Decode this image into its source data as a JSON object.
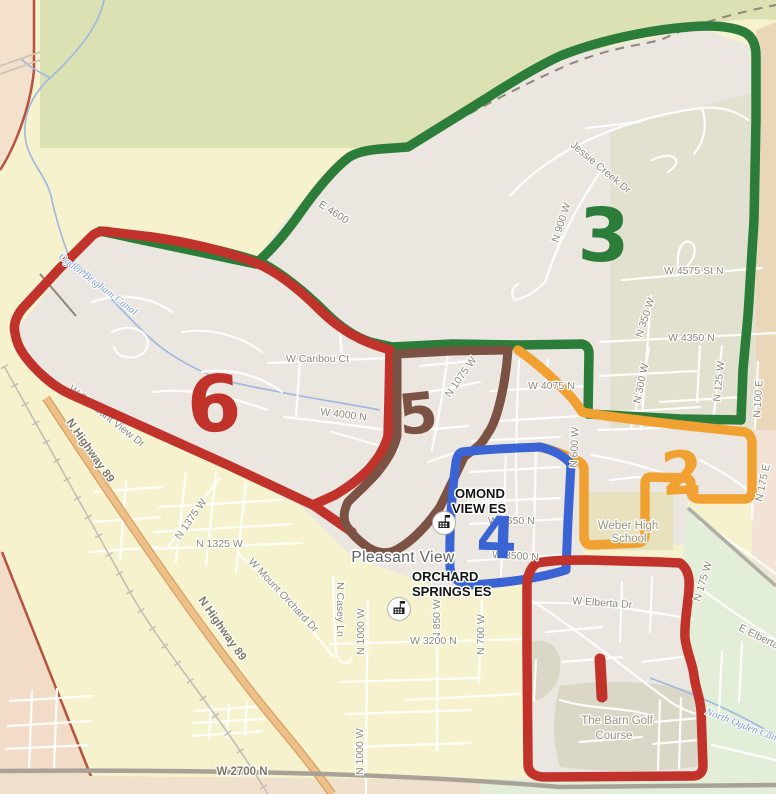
{
  "title": "Pleasant View elementary zones map",
  "city": {
    "name": "Pleasant View"
  },
  "zones": [
    {
      "id": "zone-1",
      "label": "1",
      "color": "#c1332a"
    },
    {
      "id": "zone-2",
      "label": "2",
      "color": "#f1a132"
    },
    {
      "id": "zone-3",
      "label": "3",
      "color": "#2c7d3a"
    },
    {
      "id": "zone-4",
      "label": "4",
      "color": "#3a63d3"
    },
    {
      "id": "zone-5",
      "label": "5",
      "color": "#7b5244"
    },
    {
      "id": "zone-6",
      "label": "6",
      "color": "#c1332a"
    }
  ],
  "places": {
    "ormond_view_line1": "OMOND",
    "ormond_view_line2": "VIEW ES",
    "orchard_springs_line1": "ORCHARD",
    "orchard_springs_line2": "SPRINGS ES",
    "weber_line1": "Weber High",
    "weber_line2": "School",
    "golf_line1": "The Barn Golf",
    "golf_line2": "Course"
  },
  "waterways": {
    "brigham_canal": "Ogden Brigham Canal",
    "north_ogden_canal": "North Ogden Canal"
  },
  "icons": {
    "school_icon": "school-building-with-flag"
  },
  "streets": {
    "jessie_creek": "Jessie Creek Dr",
    "n900w": "N 900 W",
    "w4575": "W 4575 St N",
    "n350w": "N 350 W",
    "w4350": "W 4350 N",
    "n300w": "N 300 W",
    "n125w": "N 125 W",
    "n100e": "N 100 E",
    "e4600": "E 4600",
    "w4075": "W 4075 N",
    "n600w": "N 600 W",
    "caribou": "W Caribou Ct",
    "n1075w": "N 1075 W",
    "w4000": "W 4000 N",
    "pleasant_view_dr": "W Pleasant View Dr",
    "hwy89": "N Highway 89",
    "n1375w": "N 1375 W",
    "n1325w": "N 1325 W",
    "mount_orchard": "W Mount Orchard Dr",
    "casey": "N Casey Ln",
    "n1000w": "N 1000 W",
    "n850w": "N 850 W",
    "n700w": "N 700 W",
    "w3200": "W 3200 N",
    "w2700": "W 2700 N",
    "w3650": "W 3650 N",
    "w3500": "W 3500 N",
    "w_elberta": "W Elberta Dr",
    "e_elberta": "E Elberta Dr",
    "n175w": "N 175 W",
    "n175e": "N 175 E"
  }
}
